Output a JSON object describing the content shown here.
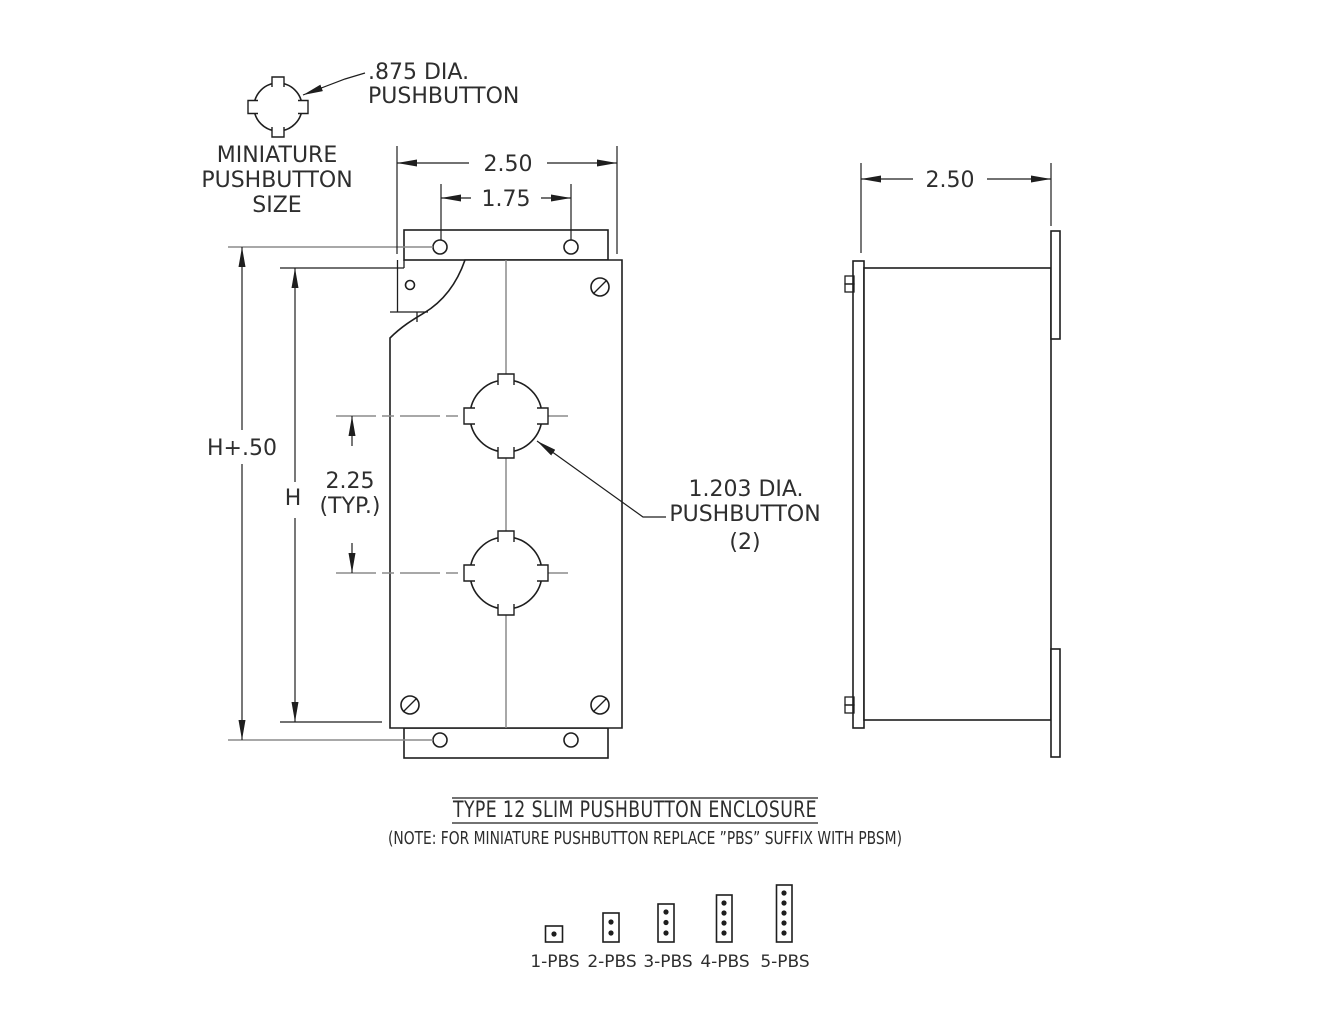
{
  "colors": {
    "line": "#1e1e1e",
    "centerline": "#8b8b8b",
    "text": "#2e2e2e",
    "background": "#ffffff"
  },
  "miniature_symbol": {
    "callout_line1": ".875 DIA.",
    "callout_line2": "PUSHBUTTON",
    "caption_line1": "MINIATURE",
    "caption_line2": "PUSHBUTTON",
    "caption_line3": "SIZE"
  },
  "front_view": {
    "width_dim": "2.50",
    "mounting_hole_spacing_dim": "1.75",
    "overall_height_dim": "H+.50",
    "height_dim": "H",
    "button_spacing_dim": "2.25",
    "button_spacing_qualifier": "(TYP.)",
    "button_callout_line1": "1.203 DIA.",
    "button_callout_line2": "PUSHBUTTON",
    "button_callout_line3": "(2)"
  },
  "side_view": {
    "depth_dim": "2.50"
  },
  "title_block": {
    "title": "TYPE 12 SLIM PUSHBUTTON ENCLOSURE",
    "note": "(NOTE: FOR MINIATURE PUSHBUTTON REPLACE ”PBS” SUFFIX WITH PBSM)"
  },
  "variants": [
    {
      "label": "1-PBS",
      "button_count": 1
    },
    {
      "label": "2-PBS",
      "button_count": 2
    },
    {
      "label": "3-PBS",
      "button_count": 3
    },
    {
      "label": "4-PBS",
      "button_count": 4
    },
    {
      "label": "5-PBS",
      "button_count": 5
    }
  ]
}
